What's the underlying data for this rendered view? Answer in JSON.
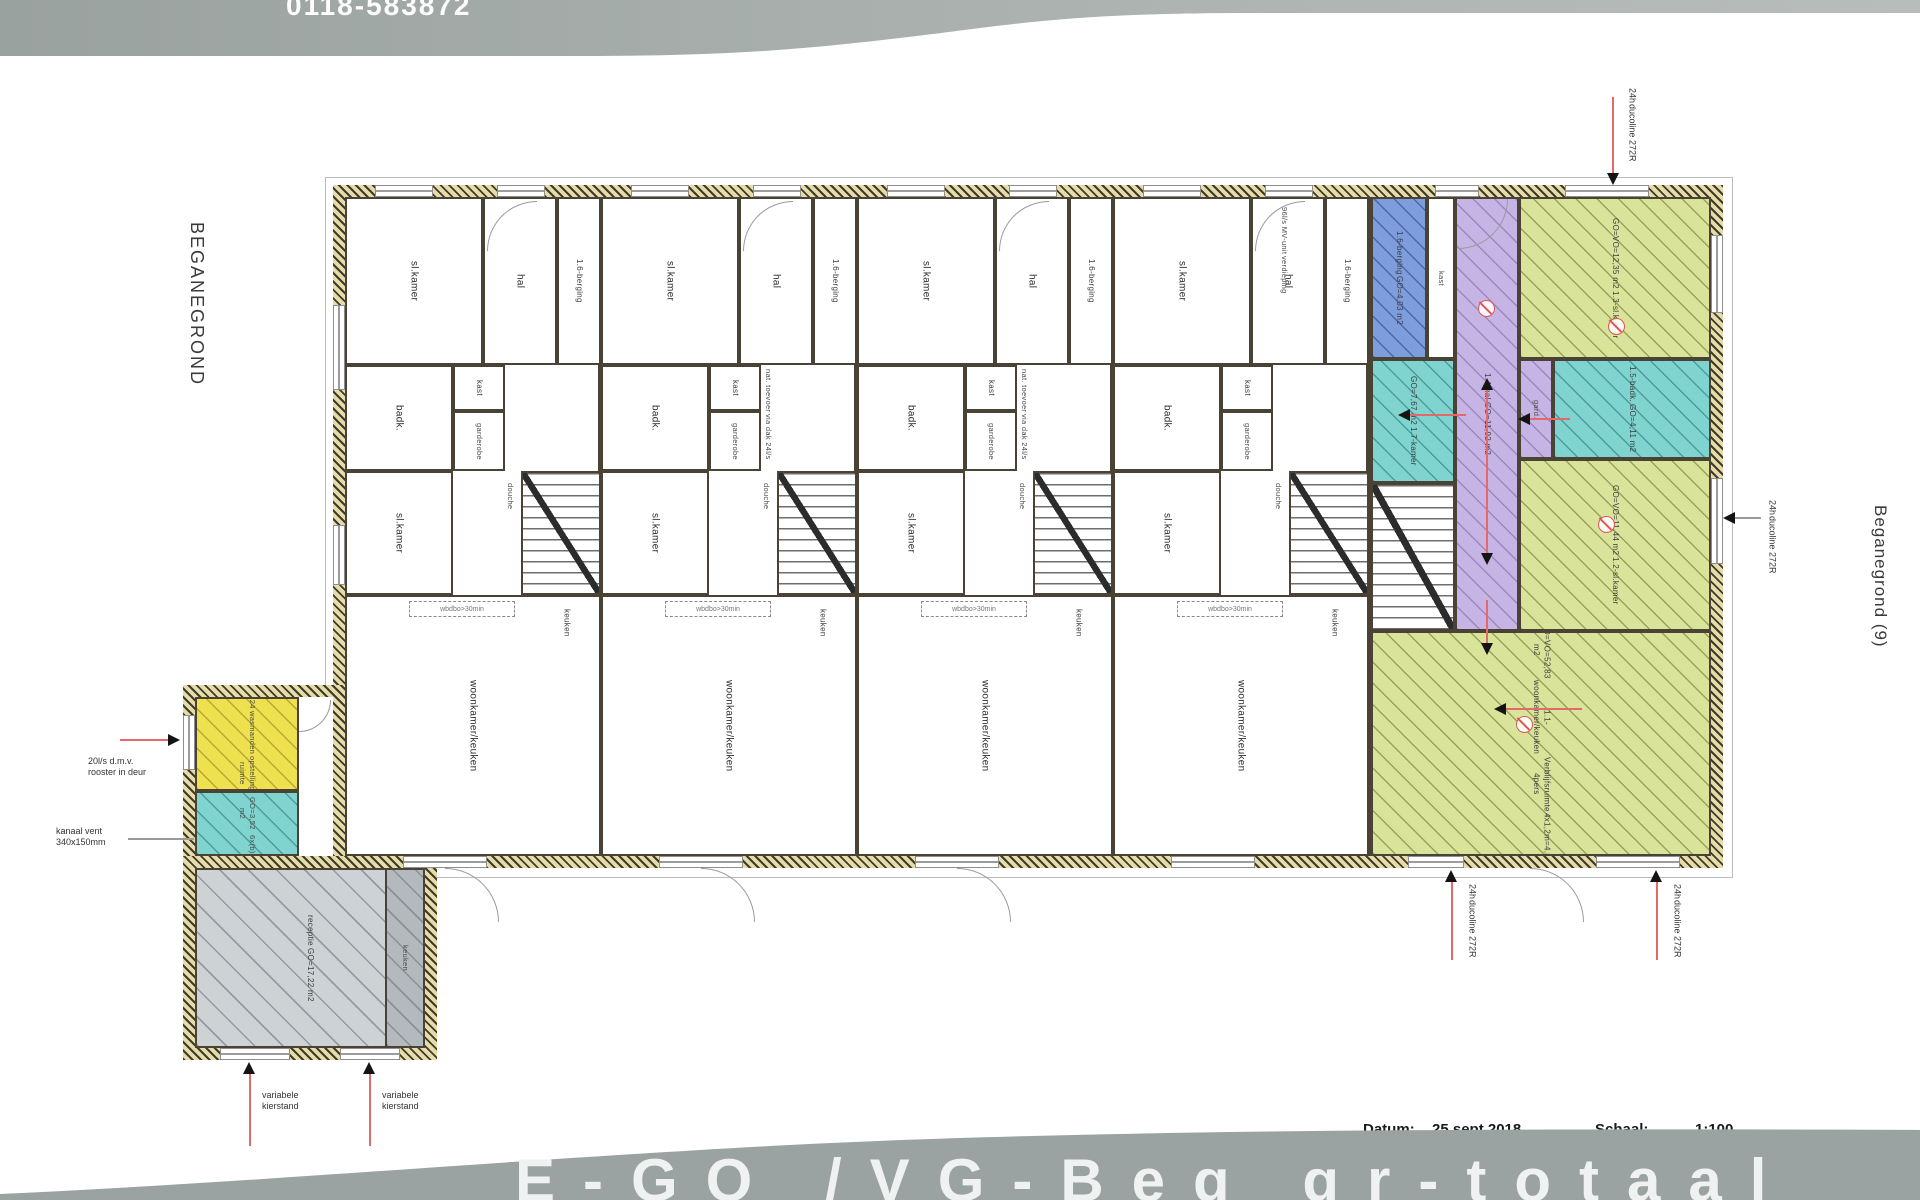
{
  "header": {
    "phone": "0118-583872"
  },
  "side_labels": {
    "left": "BEGANEGROND",
    "right": "Beganegrond (9)"
  },
  "footer": {
    "datum_label": "Datum:",
    "datum_value": "25 sept.2018",
    "schaal_label": "Schaal:",
    "schaal_value": "1:100",
    "banner_text": "E-GO /VG-Beg gr-totaal"
  },
  "plan": {
    "rooms": {
      "bedroom": "sl.kamer",
      "hall": "hal",
      "storage": "1.6-berging",
      "closet": "kast",
      "bath": "badk.",
      "wardrobe": "garderobe",
      "shower": "douche",
      "living": "woonkamer/keuken",
      "kitchen": "keuken",
      "fire_note": "wbdbo>30min",
      "vent_roof_1": "nat. toevoer",
      "vent_roof_2": "via dak 24l/s",
      "mv_unit_1": "96l/s MV-unit",
      "mv_unit_2": "verdieping"
    },
    "apartment": {
      "berging": {
        "name": "1.6-berging",
        "area": "GO=4,03 m2"
      },
      "room17": {
        "name": "1.7-kamer",
        "area": "GO=7,67 m2"
      },
      "hal14": {
        "name": "1.4-hal",
        "area": "GO=11,92 m2"
      },
      "bedroom13": {
        "name": "1.3-sl.kamer",
        "area": "GO=VO=12,35 m2"
      },
      "bath15": {
        "name": "1.5-badk.",
        "area": "GO=4,11 m2"
      },
      "bedroom12": {
        "name": "1.2-sl.kamer",
        "area": "GO=VO=11,44 m2"
      },
      "living11": {
        "name": "1.1-woonkamer/keuken",
        "area": "GO=VO=52,83 m2",
        "note1": "Verblijfsruimte 4pers",
        "note2": "4x1,2m=4,8m"
      },
      "gard": "gard."
    },
    "annex": {
      "laundry": {
        "area": "GO=4,24 m2",
        "note1": "wasmanden",
        "note2": "opstelling ruimte",
        "note3": "3x(b)"
      },
      "tech": {
        "area": "GO=3,52 m2",
        "note": "6x(b)"
      },
      "reception": {
        "name": "receptie",
        "area": "GO=17,22 m2"
      },
      "kitchen": "keuken"
    },
    "annotations": {
      "duco_1": "24h",
      "duco_2": "ducoline 272R",
      "rooster_1": "20l/s d.m.v.",
      "rooster_2": "rooster in deur",
      "kanaal_1": "kanaal vent",
      "kanaal_2": "340x150mm",
      "kierstand_1": "variabele",
      "kierstand_2": "kierstand"
    },
    "colors": {
      "green": "#d9e39a",
      "cyan": "#7fd4cf",
      "purple": "#c6b5e4",
      "blue": "#7d9ddd",
      "yellow": "#eee04e",
      "gray": "#cdd2d5",
      "wall": "#d9ce9b",
      "red": "#e05555"
    }
  }
}
